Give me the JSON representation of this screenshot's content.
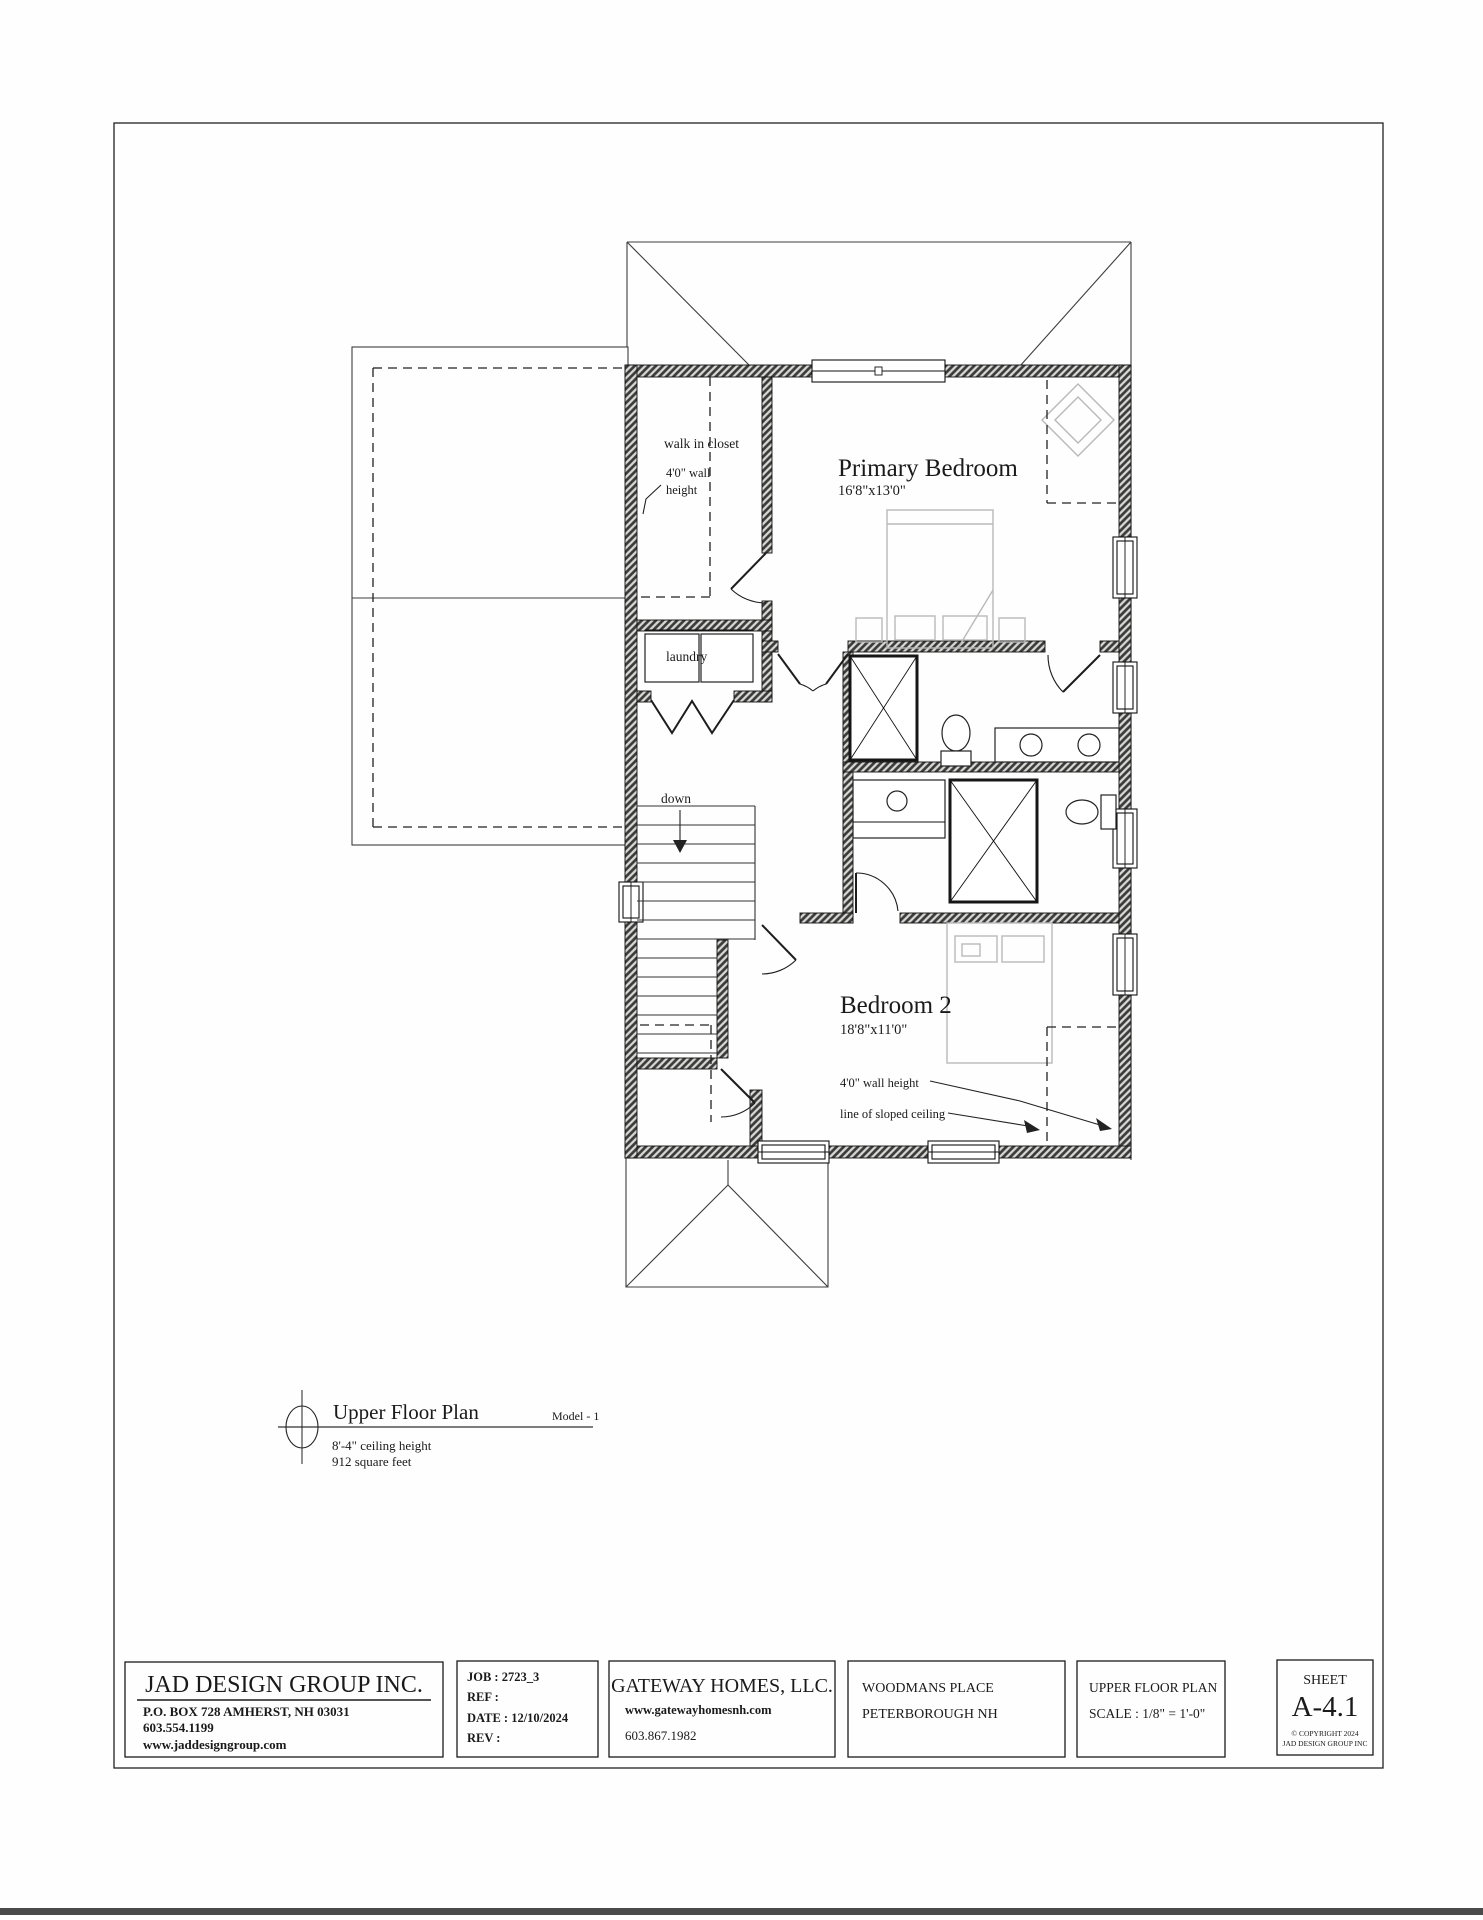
{
  "plan": {
    "labels": {
      "walk_in_closet": "walk in closet",
      "closet_wall_height_line1": "4'0\" wall",
      "closet_wall_height_line2": "height",
      "laundry": "laundry",
      "down": "down",
      "primary_bedroom": "Primary Bedroom",
      "primary_bedroom_dims": "16'8\"x13'0\"",
      "bedroom2": "Bedroom 2",
      "bedroom2_dims": "18'8\"x11'0\"",
      "bedroom2_wall_height": "4'0\" wall height",
      "sloped_ceiling": "line of sloped ceiling"
    },
    "title": {
      "name": "Upper Floor Plan",
      "model": "Model - 1",
      "ceiling": "8'-4\" ceiling height",
      "area": "912 square feet"
    }
  },
  "title_block": {
    "designer": {
      "name": "JAD DESIGN GROUP INC.",
      "address": "P.O. BOX 728 AMHERST, NH 03031",
      "phone": "603.554.1199",
      "website": "www.jaddesigngroup.com"
    },
    "job": {
      "job": "JOB : 2723_3",
      "ref": "REF :",
      "date": "DATE : 12/10/2024",
      "rev": "REV :"
    },
    "builder": {
      "name": "GATEWAY HOMES, LLC.",
      "website": "www.gatewayhomesnh.com",
      "phone": "603.867.1982"
    },
    "project": {
      "name": "WOODMANS PLACE",
      "location": "PETERBOROUGH NH"
    },
    "sheet_info": {
      "title": "UPPER FLOOR PLAN",
      "scale": "SCALE : 1/8\" = 1'-0\""
    },
    "sheet": {
      "label": "SHEET",
      "number": "A-4.1",
      "copyright1": "© COPYRIGHT 2024",
      "copyright2": "JAD DESIGN GROUP INC"
    }
  }
}
